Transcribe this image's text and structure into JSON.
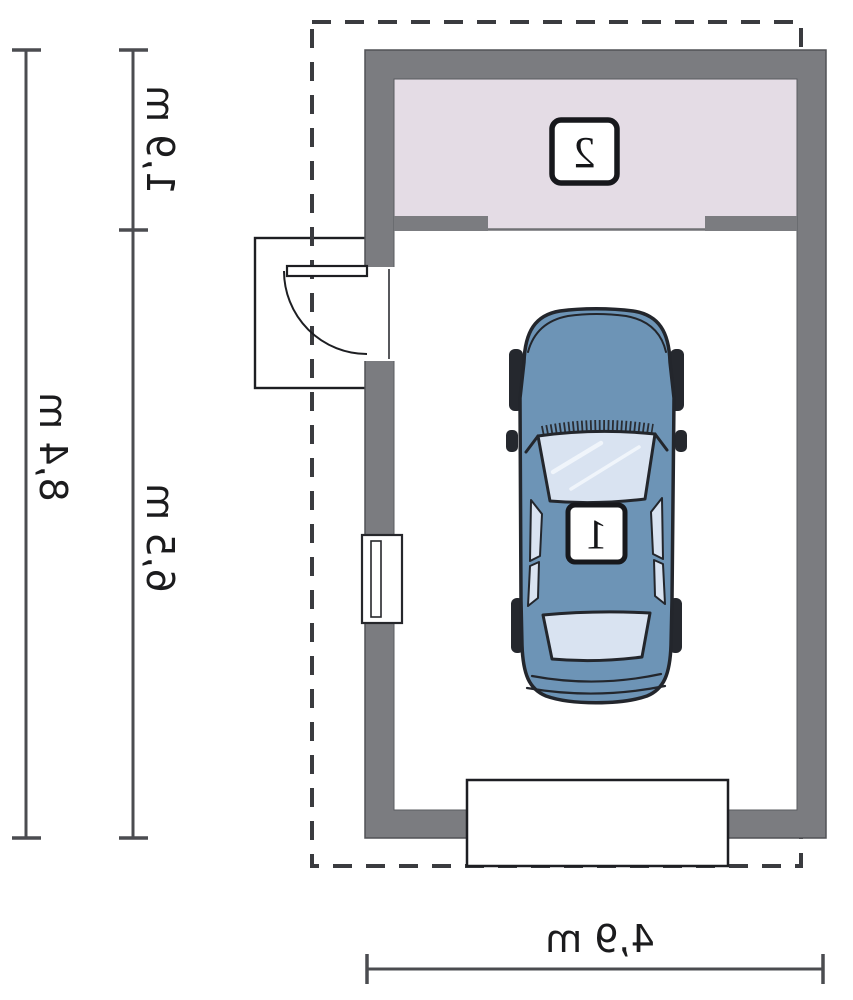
{
  "plan": {
    "type": "garage floor plan (mirrored print)",
    "rooms": [
      {
        "number": "2"
      },
      {
        "number": "1"
      }
    ],
    "dimensions": {
      "side_total": "8,4 m",
      "side_upper": "1,9 m",
      "side_lower": "6,5 m",
      "bottom_width": "4,9 m"
    },
    "colors": {
      "wall": "#7b7c80",
      "wall_edge": "#55565a",
      "room2_floor": "#e4dce5",
      "car_body": "#6d94b6",
      "glass": "#d9e3f1",
      "outline": "#1d1e22",
      "dash": "#3a3b3f",
      "dimension_line": "#4b4c50",
      "text": "#1b1b1d"
    }
  }
}
